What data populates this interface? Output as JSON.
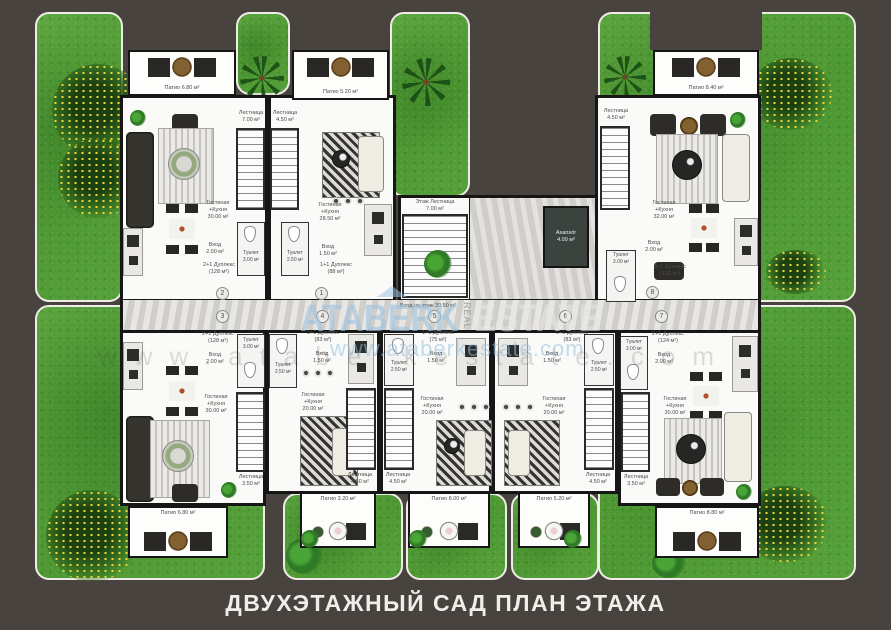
{
  "page": {
    "caption": "ДВУХЭТАЖНЫЙ САД ПЛАН ЭТАЖА",
    "background": "#49433f"
  },
  "watermark": {
    "brand": "ATABERK",
    "brand_mid": "REAL",
    "brand_end": "ESTATE",
    "url": "www.ataberkestate.com"
  },
  "core": {
    "floor_stairs": "Этаж Лестница\n7.00 м²",
    "elevator": "Asansör\n4.00 м²",
    "hall": "Вход на этаж 30.50 м²"
  },
  "units": {
    "u1": {
      "number": "1",
      "type_area": "1+1 Дуплекс\n(88 м²)",
      "living": "Гостиная\n+Кухня\n28.50 м²",
      "entry": "Вход\n1.50 м²",
      "wc": "Туалет\n2.50 м²",
      "stairs": "Лестница\n4.50 м²",
      "patio": "Патио 5.20 м²"
    },
    "u2": {
      "number": "2",
      "type_area": "2+1 Дуплекс\n(128 м²)",
      "living": "Гостиная\n+Кухня\n30.00 м²",
      "entry": "Вход\n2.00 м²",
      "wc": "Туалет\n3.00 м²",
      "stairs": "Лестница\n7.00 м²",
      "patio": "Патио 6.80 м²"
    },
    "u3": {
      "number": "3",
      "type_area": "2+1 Дуплекс\n(128 м²)",
      "living": "Гостиная\n+Кухня\n30.00 м²",
      "entry": "Вход\n2.00 м²",
      "wc": "Туалет\n3.00 м²",
      "stairs": "Лестница\n3.50 м²",
      "patio": "Патио 6.80 м²"
    },
    "u4": {
      "number": "4",
      "type_area": "1+1 Дуплекс\n(83 м²)",
      "living": "Гостиная\n+Кухня\n20.00 м²",
      "entry": "Вход\n1.50 м²",
      "wc": "Туалет\n2.50 м²",
      "stairs": "Лестница\n4.50 м²",
      "patio": "Патио 3.20 м²"
    },
    "u5": {
      "number": "5",
      "type_area": "1+1 Дуплекс\n(75 м²)",
      "living": "Гостиная\n+Кухня\n20.00 м²",
      "entry": "Вход\n1.50 м²",
      "wc": "Туалет\n2.50 м²",
      "stairs": "Лестница\n4.50 м²",
      "patio": "Патио 8.00 м²"
    },
    "u6": {
      "number": "6",
      "type_area": "1+1 Дуплекс\n(83 м²)",
      "living": "Гостиная\n+Кухня\n20.00 м²",
      "entry": "Вход\n1.50 м²",
      "wc": "Туалет\n2.50 м²",
      "stairs": "Лестница\n4.50 м²",
      "patio": "Патио 5.20 м²"
    },
    "u7": {
      "number": "7",
      "type_area": "2+1 Дуплекс\n(124 м²)",
      "living": "Гостиная\n+Кухня\n30.00 м²",
      "entry": "Вход\n2.00 м²",
      "wc": "Туалет\n3.00 м²",
      "stairs": "Лестница\n3.50 м²",
      "patio": "Патио 8.80 м²"
    },
    "u8": {
      "number": "8",
      "type_area": "2+1 Дуплекс\n(132 м²)",
      "living": "Гостиная\n+Кухня\n32.00 м²",
      "entry": "Вход\n2.00 м²",
      "wc": "Туалет\n3.00 м²",
      "stairs": "Лестница\n4.50 м²",
      "patio": "Патио 8.40 м²"
    }
  },
  "colors": {
    "grass": "#55a038",
    "wall": "#161616",
    "watermark_blue": "#9ec3e1",
    "background": "#49433f"
  }
}
